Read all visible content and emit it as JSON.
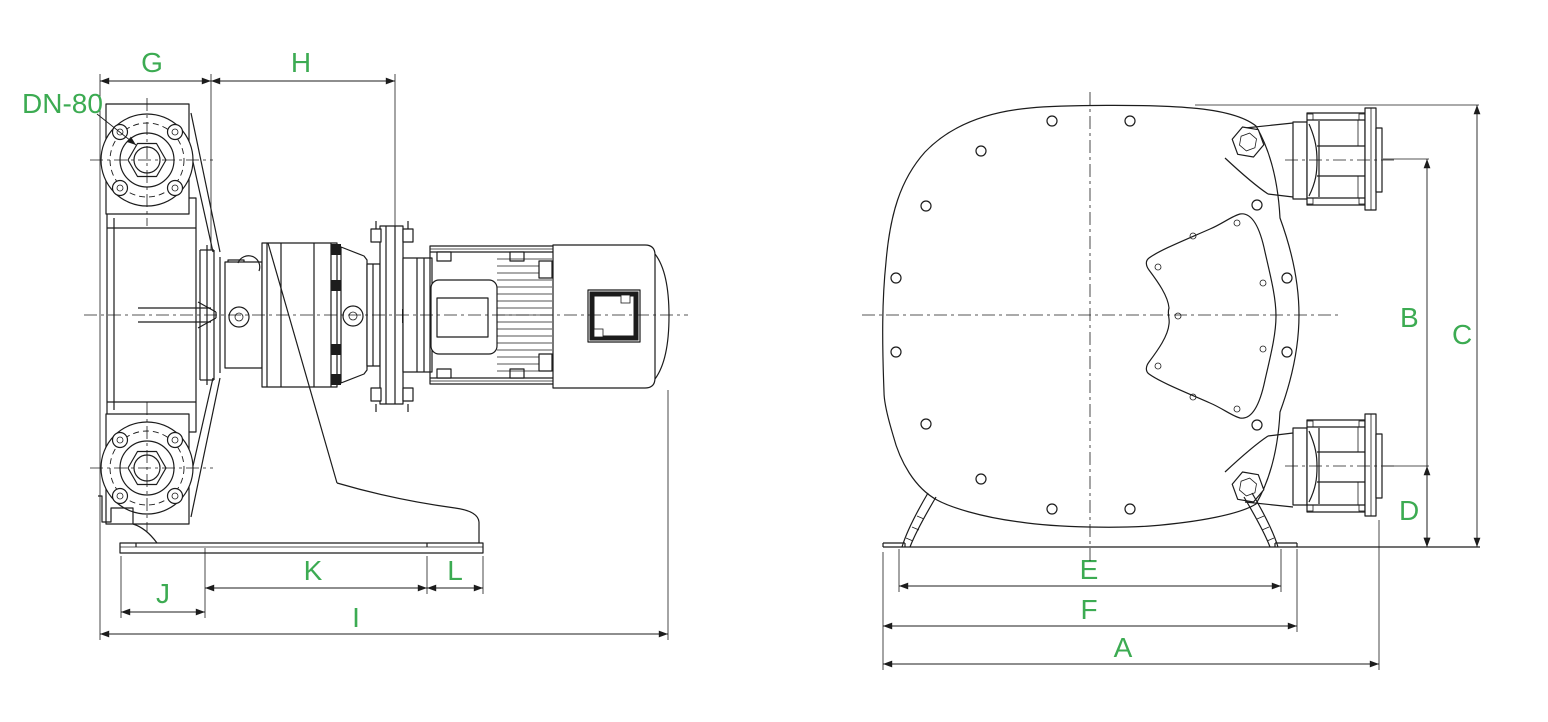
{
  "colors": {
    "background": "#ffffff",
    "line": "#1c1c1c",
    "dimension_text": "#3cab52"
  },
  "labels": {
    "dn80": "DN-80",
    "a": "A",
    "b": "B",
    "c": "C",
    "d": "D",
    "e": "E",
    "f": "F",
    "g": "G",
    "h": "H",
    "i": "I",
    "j": "J",
    "k": "K",
    "l": "L"
  },
  "views": {
    "side_view_dimensions": [
      "G",
      "H",
      "J",
      "K",
      "L",
      "I"
    ],
    "front_view_dimensions": [
      "B",
      "C",
      "D",
      "E",
      "F",
      "A"
    ],
    "port_size_annotation": "DN-80"
  }
}
